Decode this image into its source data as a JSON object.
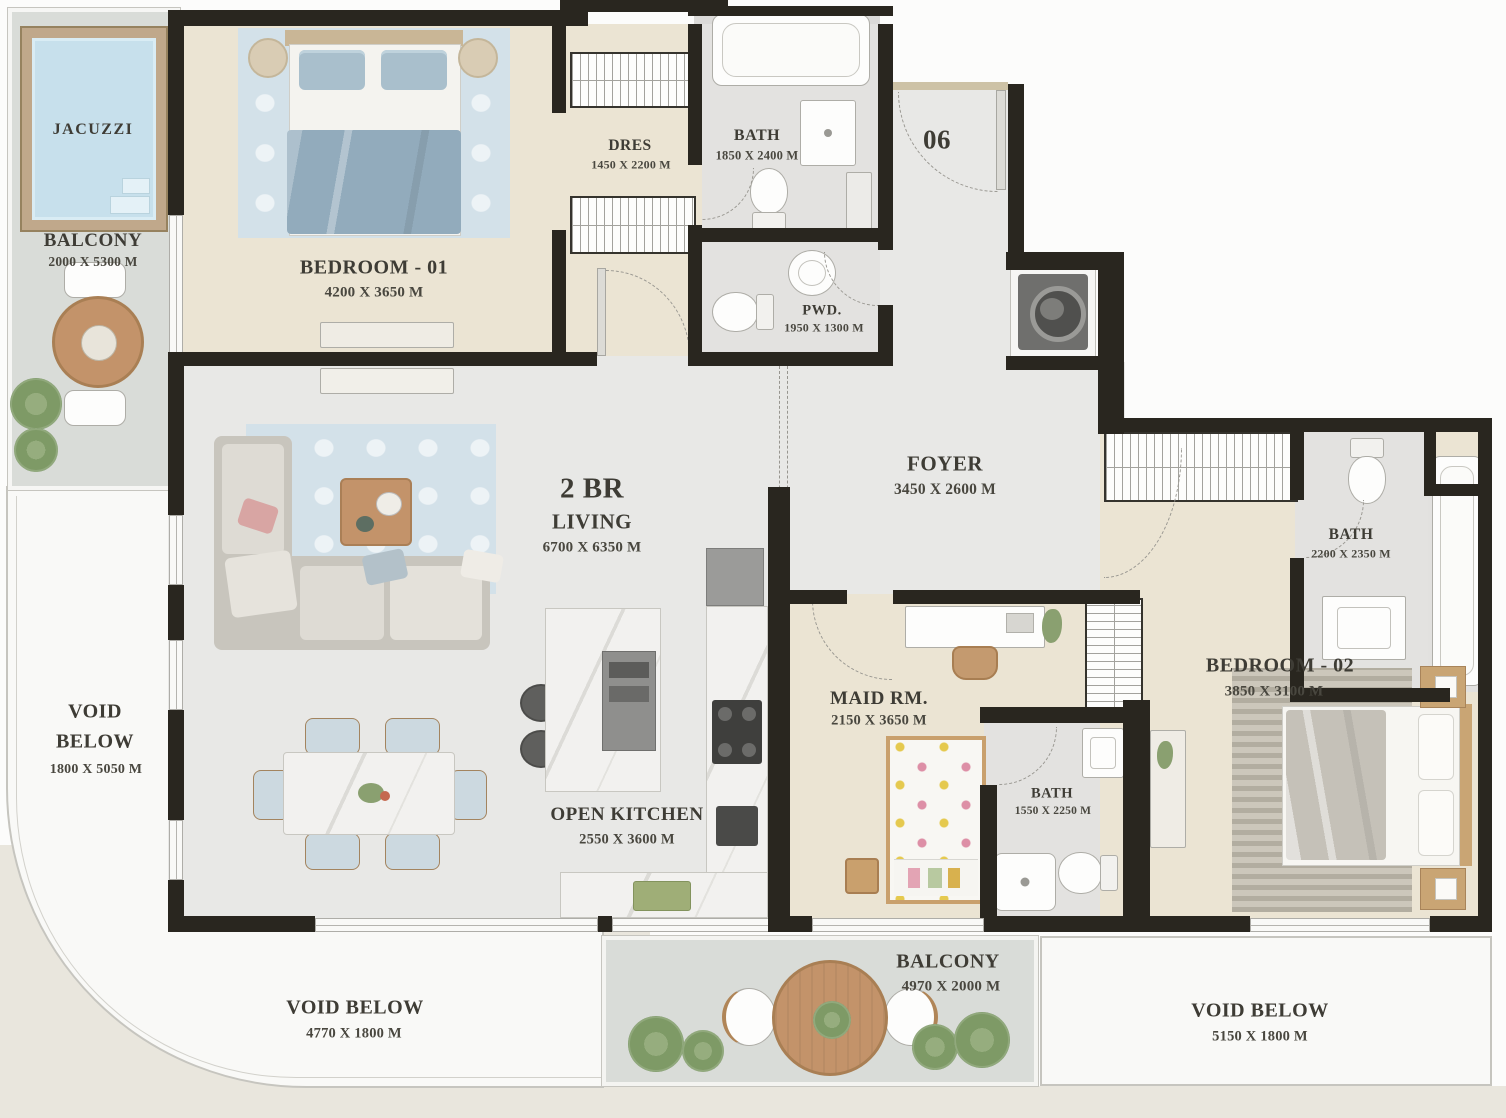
{
  "plan": {
    "unit_number": "06",
    "labels": {
      "jacuzzi": {
        "name": "JACUZZI"
      },
      "balcony_left": {
        "name": "BALCONY",
        "size": "2000 X 5300 M"
      },
      "bedroom1": {
        "name": "BEDROOM - 01",
        "size": "4200 X 3650 M"
      },
      "dres": {
        "name": "DRES",
        "size": "1450 X 2200 M"
      },
      "bath1": {
        "name": "BATH",
        "size": "1850 X 2400 M"
      },
      "pwd": {
        "name": "PWD.",
        "size": "1950 X 1300 M"
      },
      "foyer": {
        "name": "FOYER",
        "size": "3450 X 2600 M"
      },
      "living": {
        "type": "2 BR",
        "name": "LIVING",
        "size": "6700 X 6350 M"
      },
      "open_kitchen": {
        "name": "OPEN KITCHEN",
        "size": "2550 X 3600 M"
      },
      "maid_room": {
        "name": "MAID RM.",
        "size": "2150 X 3650 M"
      },
      "maid_bath": {
        "name": "BATH",
        "size": "1550 X 2250 M"
      },
      "bath2": {
        "name": "BATH",
        "size": "2200 X 2350 M"
      },
      "bedroom2": {
        "name": "BEDROOM - 02",
        "size": "3850 X 3100 M"
      },
      "balcony_bottom": {
        "name": "BALCONY",
        "size": "4970 X 2000 M"
      },
      "void_left": {
        "line1": "VOID",
        "line2": "BELOW",
        "size": "1800 X 5050 M"
      },
      "void_bottom_left": {
        "name": "VOID BELOW",
        "size": "4770 X 1800 M"
      },
      "void_bottom_right": {
        "name": "VOID BELOW",
        "size": "5150 X 1800 M"
      }
    },
    "colors": {
      "wall": "#29261f",
      "floor-beige": "#ebe4d3",
      "floor-gray": "#e8e8e6",
      "floor-marble": "#e3e2e0",
      "balcony": "#d9dcd8",
      "water": "#c7e0ec",
      "wood": "#c3936a",
      "rug-blue": "#d3e1e9",
      "void-bg": "#f9f9f7",
      "outside-beige": "#e9e6dd"
    }
  }
}
